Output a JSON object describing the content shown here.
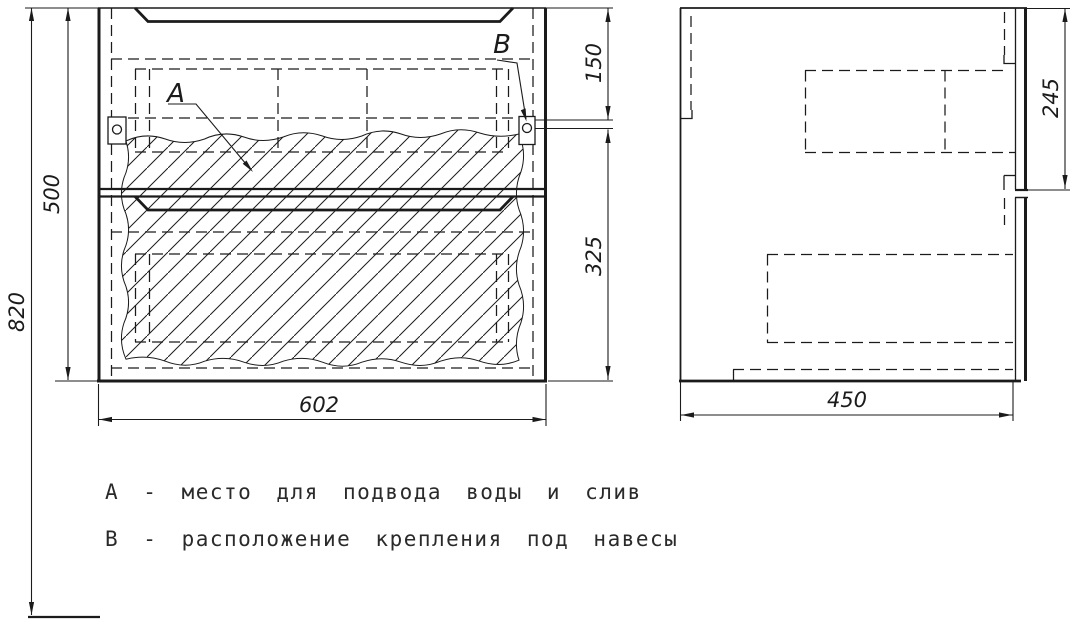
{
  "drawing": {
    "type": "furniture-technical-drawing",
    "callout_a": "А",
    "callout_b": "В",
    "dims": {
      "overall_height": "820",
      "cabinet_height": "500",
      "top_to_hanger": "150",
      "hanger_to_bottom": "325",
      "cabinet_width": "602",
      "cabinet_depth": "450",
      "hanger_zone_height": "245"
    },
    "legend": {
      "line_a": "А - место для подвода воды и слив",
      "line_b": "В - расположение крепления под навесы"
    },
    "colors": {
      "line": "#1b1b1b",
      "background": "#ffffff"
    }
  }
}
